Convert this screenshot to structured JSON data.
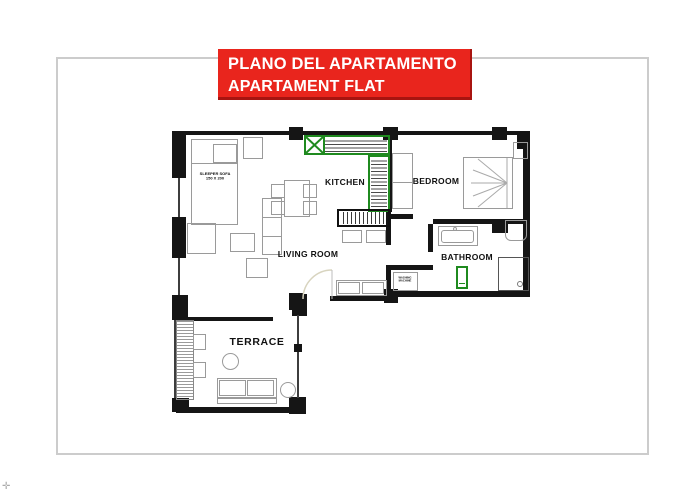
{
  "title_banner": {
    "line1": "PLANO DEL APARTAMENTO",
    "line2": "APARTAMENT FLAT"
  },
  "rooms": {
    "kitchen": "KITCHEN",
    "bedroom": "BEDROOM",
    "living_room": "LIVING ROOM",
    "bathroom": "BATHROOM",
    "terrace": "TERRACE"
  },
  "furniture_labels": {
    "sleeper_sofa_line1": "SLEEPER SOFA",
    "sleeper_sofa_line2": "150 X 200",
    "washing_machine_line1": "WASHING",
    "washing_machine_line2": "MACHINE"
  },
  "colors": {
    "accent_red": "#e9251d",
    "accent_green": "#1f8a1f",
    "wall": "#151515",
    "furniture_outline": "#9a9a9a",
    "frame_border": "#cccccc"
  },
  "corner_mark": "✛"
}
